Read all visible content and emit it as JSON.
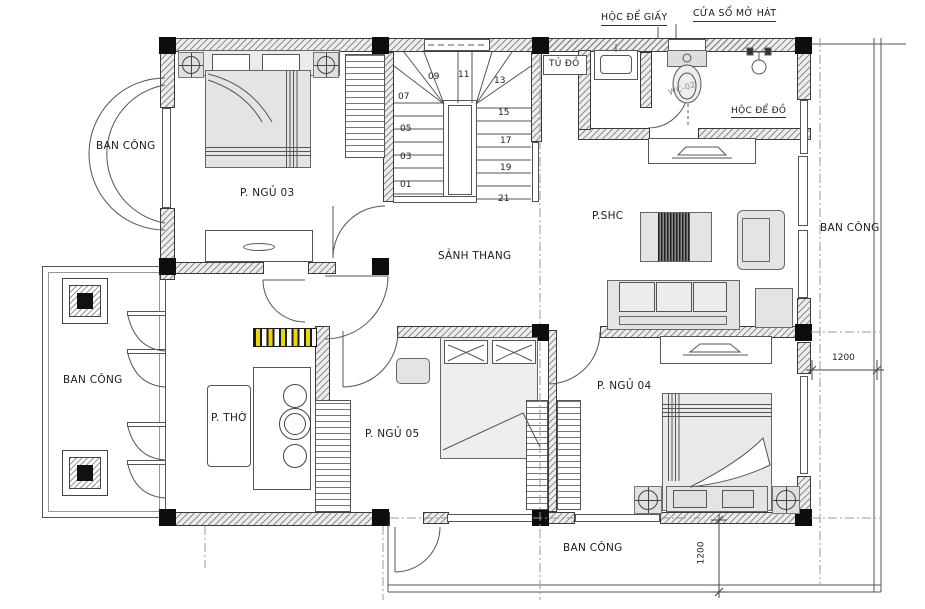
{
  "type": "floor-plan",
  "rooms": {
    "bedroom3": "P. NGỦ 03",
    "stair_hall": "SẢNH THANG",
    "family_room": "P.SHC",
    "worship_room": "P. THỜ",
    "bedroom5": "P. NGỦ 05",
    "bedroom4": "P. NGỦ 04"
  },
  "balconies": {
    "top_left": "BAN CÔNG",
    "left": "BAN CÔNG",
    "right": "BAN CÔNG",
    "bottom": "BAN CÔNG"
  },
  "annotations": {
    "paper_shelf": "HỘC ĐỂ GIẤY",
    "tilt_window": "CỬA SỔ MỞ HÁT",
    "closet": "TỦ ĐỒ",
    "storage_shelf": "HỘC ĐỂ ĐỒ",
    "wc_code": "WC-02"
  },
  "stairs": {
    "numbers": [
      "01",
      "03",
      "05",
      "07",
      "09",
      "11",
      "13",
      "15",
      "17",
      "19",
      "21"
    ]
  },
  "dimensions": {
    "right": "1200",
    "bottom": "1200"
  },
  "colors": {
    "line": "#555555",
    "column": "#0d0d0d",
    "furniture": "#e4e4e4",
    "screen_yellow": "#e6d800",
    "hatch": "#8f8f8f"
  }
}
